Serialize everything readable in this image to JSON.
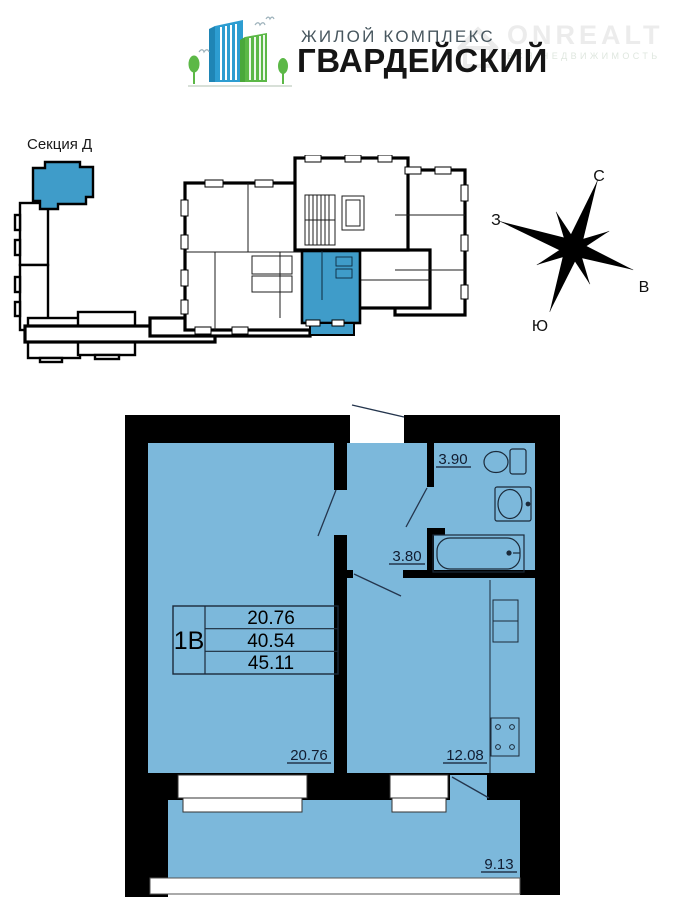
{
  "header": {
    "complex_label": "ЖИЛОЙ КОМПЛЕКС",
    "complex_name": "ГВАРДЕЙСКИЙ",
    "watermark": {
      "brand": "ONREALT",
      "tagline": "ВСЯ НЕДВИЖИМОСТЬ"
    }
  },
  "section": {
    "label": "Секция Д"
  },
  "compass": {
    "north": "С",
    "east": "В",
    "south": "Ю",
    "west": "З"
  },
  "apartment": {
    "type": "1В",
    "areas": {
      "living": "20.76",
      "total": "40.54",
      "total_with_balcony": "45.11"
    },
    "rooms": {
      "wc": "3.90",
      "hall": "3.80",
      "living": "20.76",
      "kitchen": "12.08",
      "balcony": "9.13"
    }
  },
  "colors": {
    "plan_fill": "#7cb8db",
    "highlight": "#3f9cc9",
    "wall": "#000000",
    "logo_blue": "#2d9dd1",
    "logo_green": "#5cb847"
  }
}
